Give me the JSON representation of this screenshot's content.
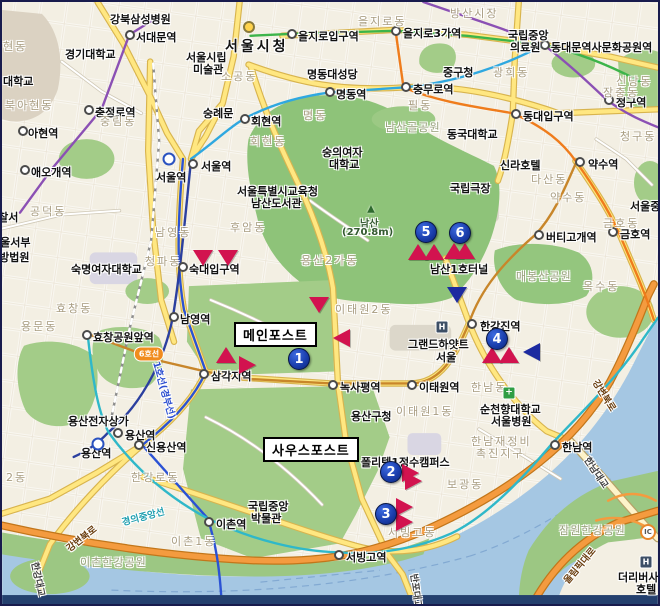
{
  "map": {
    "width": 660,
    "height": 606,
    "colors": {
      "marker_red": "#d2134f",
      "marker_blue": "#1c2aa0",
      "numbered_pin": "#16359f",
      "park_green": "#a3cc88",
      "namsan_green": "#8ec379",
      "water": "#a5c7e3",
      "road_orange": "#f49b3f",
      "road_yellow": "#ffe781",
      "district_text": "#a89c80"
    },
    "callouts": [
      {
        "name": "callout-main-post",
        "label": "메인포스트",
        "x": 232,
        "y": 320
      },
      {
        "name": "callout-south-post",
        "label": "사우스포스트",
        "x": 261,
        "y": 435
      }
    ],
    "numbered_markers": [
      {
        "n": "1",
        "x": 297,
        "y": 357
      },
      {
        "n": "2",
        "x": 389,
        "y": 470
      },
      {
        "n": "3",
        "x": 384,
        "y": 512
      },
      {
        "n": "4",
        "x": 495,
        "y": 337
      },
      {
        "n": "5",
        "x": 424,
        "y": 230
      },
      {
        "n": "6",
        "x": 458,
        "y": 231
      }
    ],
    "triangle_markers": [
      {
        "x": 201,
        "y": 256,
        "dir": "down",
        "color": "red"
      },
      {
        "x": 226,
        "y": 256,
        "dir": "down",
        "color": "red"
      },
      {
        "x": 317,
        "y": 303,
        "dir": "down",
        "color": "red"
      },
      {
        "x": 339,
        "y": 336,
        "dir": "left",
        "color": "red"
      },
      {
        "x": 224,
        "y": 353,
        "dir": "up",
        "color": "red"
      },
      {
        "x": 246,
        "y": 363,
        "dir": "right",
        "color": "red"
      },
      {
        "x": 416,
        "y": 250,
        "dir": "up",
        "color": "red"
      },
      {
        "x": 432,
        "y": 250,
        "dir": "up",
        "color": "red"
      },
      {
        "x": 452,
        "y": 249,
        "dir": "up",
        "color": "red"
      },
      {
        "x": 463,
        "y": 249,
        "dir": "up",
        "color": "red"
      },
      {
        "x": 490,
        "y": 353,
        "dir": "up",
        "color": "red"
      },
      {
        "x": 507,
        "y": 353,
        "dir": "up",
        "color": "red"
      },
      {
        "x": 529,
        "y": 350,
        "dir": "left",
        "color": "blue"
      },
      {
        "x": 455,
        "y": 293,
        "dir": "down",
        "color": "blue"
      },
      {
        "x": 409,
        "y": 471,
        "dir": "right",
        "color": "red"
      },
      {
        "x": 412,
        "y": 479,
        "dir": "right",
        "color": "red"
      },
      {
        "x": 403,
        "y": 505,
        "dir": "right",
        "color": "red"
      },
      {
        "x": 403,
        "y": 520,
        "dir": "right",
        "color": "red"
      }
    ],
    "labels": [
      {
        "t": "서울시청",
        "x": 223,
        "y": 34,
        "k": "city"
      },
      {
        "t": "서대문역",
        "x": 134,
        "y": 27,
        "k": "st",
        "d": [
          128,
          33
        ]
      },
      {
        "t": "충정로역",
        "x": 93,
        "y": 102,
        "k": "st",
        "d": [
          87,
          108
        ]
      },
      {
        "t": "아현역",
        "x": 26,
        "y": 123,
        "k": "st",
        "d": [
          21,
          129
        ]
      },
      {
        "t": "애오개역",
        "x": 29,
        "y": 162,
        "k": "st",
        "d": [
          23,
          168
        ]
      },
      {
        "t": "을지로입구역",
        "x": 296,
        "y": 26,
        "k": "st",
        "d": [
          290,
          32
        ]
      },
      {
        "t": "을지로3가역",
        "x": 401,
        "y": 23,
        "k": "st",
        "d": [
          394,
          29
        ]
      },
      {
        "t": "동대문역사문화공원역",
        "x": 549,
        "y": 37,
        "k": "st",
        "d": [
          543,
          43
        ]
      },
      {
        "t": "명동역",
        "x": 334,
        "y": 84,
        "k": "st",
        "d": [
          328,
          90
        ]
      },
      {
        "t": "회현역",
        "x": 249,
        "y": 111,
        "k": "st",
        "d": [
          243,
          117
        ]
      },
      {
        "t": "충무로역",
        "x": 411,
        "y": 79,
        "k": "st",
        "d": [
          404,
          85
        ]
      },
      {
        "t": "동대입구역",
        "x": 521,
        "y": 106,
        "k": "st",
        "d": [
          514,
          112
        ]
      },
      {
        "t": "청구역",
        "x": 614,
        "y": 92,
        "k": "st",
        "d": [
          607,
          98
        ]
      },
      {
        "t": "약수역",
        "x": 586,
        "y": 154,
        "k": "st",
        "d": [
          578,
          160
        ]
      },
      {
        "t": "버티고개역",
        "x": 544,
        "y": 227,
        "k": "st",
        "d": [
          537,
          233
        ]
      },
      {
        "t": "금호역",
        "x": 618,
        "y": 224,
        "k": "st",
        "d": [
          611,
          230
        ]
      },
      {
        "t": "서울역",
        "x": 199,
        "y": 156,
        "k": "st",
        "d": [
          191,
          162
        ]
      },
      {
        "t": "서울역",
        "x": 154,
        "y": 167,
        "k": "st"
      },
      {
        "t": "숙대입구역",
        "x": 187,
        "y": 259,
        "k": "st",
        "d": [
          181,
          265
        ]
      },
      {
        "t": "남영역",
        "x": 178,
        "y": 309,
        "k": "st",
        "d": [
          172,
          315
        ]
      },
      {
        "t": "효창공원앞역",
        "x": 91,
        "y": 327,
        "k": "st",
        "d": [
          85,
          333
        ]
      },
      {
        "t": "삼각지역",
        "x": 209,
        "y": 366,
        "k": "st",
        "d": [
          202,
          372
        ]
      },
      {
        "t": "녹사평역",
        "x": 338,
        "y": 377,
        "k": "st",
        "d": [
          331,
          383
        ]
      },
      {
        "t": "이태원역",
        "x": 417,
        "y": 377,
        "k": "st",
        "d": [
          410,
          383
        ]
      },
      {
        "t": "한강진역",
        "x": 478,
        "y": 316,
        "k": "st",
        "d": [
          470,
          322
        ]
      },
      {
        "t": "한남역",
        "x": 560,
        "y": 437,
        "k": "st",
        "d": [
          553,
          443
        ]
      },
      {
        "t": "용산역",
        "x": 123,
        "y": 425,
        "k": "st",
        "d": [
          116,
          431
        ]
      },
      {
        "t": "용산역",
        "x": 79,
        "y": 443,
        "k": "st"
      },
      {
        "t": "신용산역",
        "x": 144,
        "y": 437,
        "k": "st",
        "d": [
          137,
          443
        ]
      },
      {
        "t": "이촌역",
        "x": 214,
        "y": 514,
        "k": "st",
        "d": [
          207,
          520
        ]
      },
      {
        "t": "서빙고역",
        "x": 344,
        "y": 547,
        "k": "st",
        "d": [
          337,
          553
        ]
      },
      {
        "t": "강북삼성병원",
        "x": 108,
        "y": 9,
        "k": "poi"
      },
      {
        "t": "경기대학교",
        "x": 63,
        "y": 44,
        "k": "poi"
      },
      {
        "t": "서울시립",
        "x": 184,
        "y": 47,
        "k": "poi"
      },
      {
        "t": "미술관",
        "x": 191,
        "y": 59,
        "k": "poi"
      },
      {
        "t": "숭례문",
        "x": 201,
        "y": 103,
        "k": "poi"
      },
      {
        "t": "명동대성당",
        "x": 305,
        "y": 64,
        "k": "poi"
      },
      {
        "t": "중구청",
        "x": 441,
        "y": 62,
        "k": "poi"
      },
      {
        "t": "국립중앙",
        "x": 506,
        "y": 25,
        "k": "poi"
      },
      {
        "t": "의료원",
        "x": 508,
        "y": 37,
        "k": "poi"
      },
      {
        "t": "동국대학교",
        "x": 445,
        "y": 124,
        "k": "poi"
      },
      {
        "t": "숭의여자",
        "x": 320,
        "y": 142,
        "k": "poi"
      },
      {
        "t": "대학교",
        "x": 327,
        "y": 154,
        "k": "poi"
      },
      {
        "t": "신라호텔",
        "x": 498,
        "y": 155,
        "k": "poi"
      },
      {
        "t": "국립극장",
        "x": 448,
        "y": 178,
        "k": "poi"
      },
      {
        "t": "서울특별시교육청",
        "x": 235,
        "y": 181,
        "k": "poi"
      },
      {
        "t": "남산도서관",
        "x": 249,
        "y": 193,
        "k": "poi"
      },
      {
        "t": "숙명여자대학교",
        "x": 69,
        "y": 259,
        "k": "poi"
      },
      {
        "t": "용산전자상가",
        "x": 66,
        "y": 411,
        "k": "poi"
      },
      {
        "t": "용산구청",
        "x": 349,
        "y": 406,
        "k": "poi"
      },
      {
        "t": "그랜드하얏트",
        "x": 406,
        "y": 334,
        "k": "poi"
      },
      {
        "t": "서울",
        "x": 434,
        "y": 347,
        "k": "poi"
      },
      {
        "t": "순천향대학교",
        "x": 478,
        "y": 399,
        "k": "poi"
      },
      {
        "t": "서울병원",
        "x": 489,
        "y": 411,
        "k": "poi"
      },
      {
        "t": "폴리텍1정수캠퍼스",
        "x": 359,
        "y": 452,
        "k": "poi"
      },
      {
        "t": "국립중앙",
        "x": 246,
        "y": 496,
        "k": "poi"
      },
      {
        "t": "박물관",
        "x": 249,
        "y": 508,
        "k": "poi"
      },
      {
        "t": "더리버사이드",
        "x": 616,
        "y": 567,
        "k": "poi"
      },
      {
        "t": "호텔",
        "x": 634,
        "y": 579,
        "k": "poi"
      },
      {
        "t": "남산1호터널",
        "x": 428,
        "y": 259,
        "k": "poi"
      },
      {
        "t": "서울중",
        "x": 628,
        "y": 196,
        "k": "poi"
      },
      {
        "t": "경찰서",
        "x": -14,
        "y": 207,
        "k": "poi"
      },
      {
        "t": "서울서부",
        "x": -12,
        "y": 232,
        "k": "poi"
      },
      {
        "t": "지방법원",
        "x": -13,
        "y": 247,
        "k": "poi"
      },
      {
        "t": "대학교",
        "x": 1,
        "y": 71,
        "k": "poi"
      },
      {
        "t": "현동",
        "x": 1,
        "y": 36,
        "k": "d"
      },
      {
        "t": "북아현동",
        "x": 3,
        "y": 95,
        "k": "d"
      },
      {
        "t": "공덕동",
        "x": 28,
        "y": 201,
        "k": "d"
      },
      {
        "t": "용문동",
        "x": 19,
        "y": 316,
        "k": "d"
      },
      {
        "t": "효창동",
        "x": 54,
        "y": 298,
        "k": "d"
      },
      {
        "t": "중림동",
        "x": 98,
        "y": 111,
        "k": "d"
      },
      {
        "t": "남영동",
        "x": 153,
        "y": 222,
        "k": "d"
      },
      {
        "t": "청파동",
        "x": 143,
        "y": 251,
        "k": "d"
      },
      {
        "t": "후암동",
        "x": 228,
        "y": 217,
        "k": "d"
      },
      {
        "t": "회현동",
        "x": 248,
        "y": 131,
        "k": "d"
      },
      {
        "t": "소공동",
        "x": 219,
        "y": 66,
        "k": "d"
      },
      {
        "t": "명동",
        "x": 301,
        "y": 105,
        "k": "d"
      },
      {
        "t": "필동",
        "x": 406,
        "y": 95,
        "k": "d"
      },
      {
        "t": "을지로동",
        "x": 356,
        "y": 11,
        "k": "d"
      },
      {
        "t": "방산시장",
        "x": 448,
        "y": 3,
        "k": "d"
      },
      {
        "t": "광희동",
        "x": 491,
        "y": 62,
        "k": "d"
      },
      {
        "t": "장충동",
        "x": 601,
        "y": 82,
        "k": "d"
      },
      {
        "t": "신당동",
        "x": 614,
        "y": 71,
        "k": "d"
      },
      {
        "t": "청구동",
        "x": 618,
        "y": 126,
        "k": "d"
      },
      {
        "t": "다산동",
        "x": 529,
        "y": 169,
        "k": "d"
      },
      {
        "t": "약수동",
        "x": 548,
        "y": 187,
        "k": "d"
      },
      {
        "t": "옥수동",
        "x": 581,
        "y": 276,
        "k": "d"
      },
      {
        "t": "금호동",
        "x": 601,
        "y": 213,
        "k": "d"
      },
      {
        "t": "용산2가동",
        "x": 299,
        "y": 250,
        "k": "d"
      },
      {
        "t": "이태원2동",
        "x": 333,
        "y": 299,
        "k": "d"
      },
      {
        "t": "이태원1동",
        "x": 394,
        "y": 401,
        "k": "d"
      },
      {
        "t": "한남동",
        "x": 469,
        "y": 377,
        "k": "d"
      },
      {
        "t": "한강로동",
        "x": 129,
        "y": 467,
        "k": "d"
      },
      {
        "t": "이촌1동",
        "x": 169,
        "y": 531,
        "k": "d"
      },
      {
        "t": "2동",
        "x": 4,
        "y": 467,
        "k": "d"
      },
      {
        "t": "서빙고동",
        "x": 386,
        "y": 522,
        "k": "d"
      },
      {
        "t": "보광동",
        "x": 445,
        "y": 474,
        "k": "d"
      },
      {
        "t": "한남재정비",
        "x": 469,
        "y": 431,
        "k": "d"
      },
      {
        "t": "촉진지구",
        "x": 474,
        "y": 443,
        "k": "d"
      },
      {
        "t": "남산골공원",
        "x": 383,
        "y": 117,
        "k": "park"
      },
      {
        "t": "매봉산공원",
        "x": 514,
        "y": 266,
        "k": "park"
      },
      {
        "t": "이촌한강공원",
        "x": 78,
        "y": 552,
        "k": "park"
      },
      {
        "t": "잠원한강공원",
        "x": 557,
        "y": 520,
        "k": "park"
      },
      {
        "t": "남산",
        "x": 358,
        "y": 213,
        "k": "peak"
      },
      {
        "t": "(270.8m)",
        "x": 340,
        "y": 225,
        "k": "peak"
      },
      {
        "t": "강변북로",
        "x": 79,
        "y": 536,
        "k": "road",
        "r": -38,
        "c": "#6b3f10"
      },
      {
        "t": "강변북로",
        "x": 603,
        "y": 393,
        "k": "road",
        "r": 58,
        "c": "#6b3f10"
      },
      {
        "t": "올림픽대로",
        "x": 577,
        "y": 563,
        "k": "road",
        "r": -50,
        "c": "#6b3f10"
      },
      {
        "t": "한남대교",
        "x": 595,
        "y": 470,
        "k": "road",
        "r": 56,
        "c": "#444444"
      },
      {
        "t": "한강대교",
        "x": 37,
        "y": 577,
        "k": "road",
        "r": 78,
        "c": "#444444"
      },
      {
        "t": "반포대교",
        "x": 415,
        "y": 589,
        "k": "road",
        "r": 82,
        "c": "#444444"
      },
      {
        "t": "경의중앙선",
        "x": 141,
        "y": 514,
        "k": "road",
        "r": -15,
        "c": "#1f9fb0"
      },
      {
        "t": "1호선(경부선)",
        "x": 163,
        "y": 388,
        "k": "road",
        "r": 74,
        "c": "#2d4fd0"
      },
      {
        "t": "6호선",
        "x": 147,
        "y": 352,
        "k": "badge6"
      },
      {
        "t": "IC",
        "x": 646,
        "y": 530,
        "k": "ic"
      },
      {
        "k": "rail",
        "x": 167,
        "y": 157
      },
      {
        "k": "rail",
        "x": 96,
        "y": 442
      },
      {
        "t": "H",
        "x": 440,
        "y": 325,
        "k": "hotel"
      },
      {
        "t": "H",
        "x": 644,
        "y": 560,
        "k": "hotel"
      },
      {
        "t": "+",
        "x": 507,
        "y": 391,
        "k": "hosp"
      },
      {
        "k": "hall",
        "x": 247,
        "y": 25
      },
      {
        "t": "▲",
        "x": 369,
        "y": 207,
        "k": "peakic"
      }
    ]
  }
}
